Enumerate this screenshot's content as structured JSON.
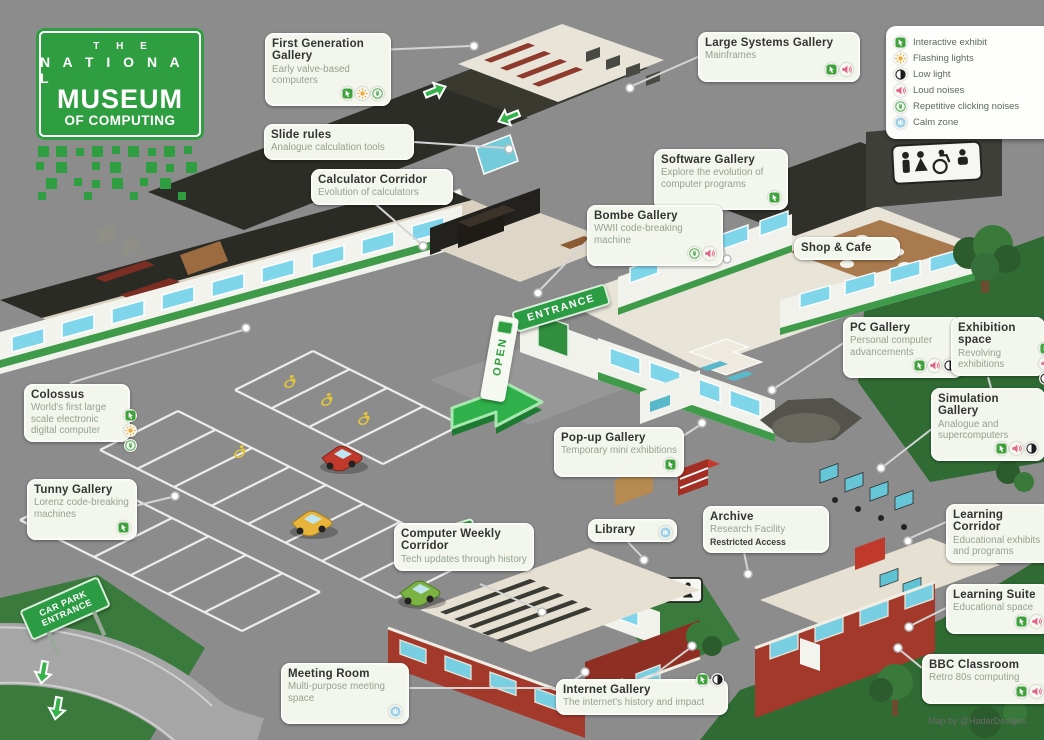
{
  "logo": {
    "line1": "T H E",
    "line2": "N A T I O N A L",
    "line3": "MUSEUM",
    "line4": "OF COMPUTING"
  },
  "legend": {
    "items": [
      {
        "icon": "interactive",
        "label": "Interactive exhibit"
      },
      {
        "icon": "flashing",
        "label": "Flashing lights"
      },
      {
        "icon": "low-light",
        "label": "Low light"
      },
      {
        "icon": "loud",
        "label": "Loud noises"
      },
      {
        "icon": "clicking",
        "label": "Repetitive clicking noises"
      },
      {
        "icon": "calm",
        "label": "Calm zone"
      }
    ]
  },
  "labels": [
    {
      "id": "first-generation-gallery",
      "title": "First Generation Gallery",
      "subtitle": "Early valve-based computers",
      "icons": [
        "interactive",
        "flashing",
        "clicking"
      ]
    },
    {
      "id": "slide-rules",
      "title": "Slide rules",
      "subtitle": "Analogue calculation tools",
      "icons": []
    },
    {
      "id": "calculator-corridor",
      "title": "Calculator Corridor",
      "subtitle": "Evolution of calculators",
      "icons": []
    },
    {
      "id": "large-systems-gallery",
      "title": "Large Systems Gallery",
      "subtitle": "Mainframes",
      "icons": [
        "interactive",
        "loud"
      ]
    },
    {
      "id": "software-gallery",
      "title": "Software Gallery",
      "subtitle": "Explore the evolution of computer programs",
      "icons": [
        "interactive"
      ]
    },
    {
      "id": "bombe-gallery",
      "title": "Bombe Gallery",
      "subtitle": "WWII code-breaking machine",
      "icons": [
        "clicking",
        "loud"
      ]
    },
    {
      "id": "shop-cafe",
      "title": "Shop & Cafe",
      "subtitle": "",
      "icons": []
    },
    {
      "id": "pc-gallery",
      "title": "PC Gallery",
      "subtitle": "Personal computer advancements",
      "icons": [
        "interactive",
        "loud",
        "low-light"
      ]
    },
    {
      "id": "exhibition-space",
      "title": "Exhibition space",
      "subtitle": "Revolving exhibitions",
      "icons": [
        "interactive",
        "loud",
        "low-light"
      ]
    },
    {
      "id": "simulation-gallery",
      "title": "Simulation Gallery",
      "subtitle": "Analogue and supercomputers",
      "icons": [
        "interactive",
        "loud",
        "low-light"
      ]
    },
    {
      "id": "pop-up-gallery",
      "title": "Pop-up Gallery",
      "subtitle": "Temporary mini exhibitions",
      "icons": [
        "interactive"
      ]
    },
    {
      "id": "colossus",
      "title": "Colossus",
      "subtitle": "World's first large scale electronic digital computer",
      "icons": [
        "interactive",
        "flashing",
        "clicking"
      ]
    },
    {
      "id": "tunny-gallery",
      "title": "Tunny Gallery",
      "subtitle": "Lorenz code-breaking machines",
      "icons": [
        "interactive"
      ]
    },
    {
      "id": "computer-weekly-corridor",
      "title": "Computer Weekly Corridor",
      "subtitle": "Tech updates through history",
      "icons": []
    },
    {
      "id": "library",
      "title": "Library",
      "subtitle": "",
      "icons": [
        "calm"
      ]
    },
    {
      "id": "archive",
      "title": "Archive",
      "subtitle": "Research Facility",
      "note": "Restricted Access",
      "icons": []
    },
    {
      "id": "learning-corridor",
      "title": "Learning Corridor",
      "subtitle": "Educational exhibits and programs",
      "icons": []
    },
    {
      "id": "learning-suite",
      "title": "Learning Suite",
      "subtitle": "Educational space",
      "icons": [
        "interactive",
        "loud"
      ]
    },
    {
      "id": "bbc-classroom",
      "title": "BBC Classroom",
      "subtitle": "Retro 80s computing",
      "icons": [
        "interactive",
        "loud"
      ]
    },
    {
      "id": "meeting-room",
      "title": "Meeting Room",
      "subtitle": "Multi-purpose meeting space",
      "icons": [
        "calm"
      ]
    },
    {
      "id": "internet-gallery",
      "title": "Internet Gallery",
      "subtitle": "The internet's history and impact",
      "icons": [
        "interactive",
        "low-light"
      ]
    }
  ],
  "signs": {
    "entrance": "ENTRANCE",
    "exit": "EXIT",
    "car_park": "CAR PARK ENTRANCE",
    "open": "OPEN"
  },
  "credit": "Map by @HaderDesigns",
  "colors": {
    "brand_green": "#2f9e41",
    "label_bg": "#f2f6ec",
    "roof": "#2d2d27",
    "grass": "#2f6b33",
    "asphalt": "#8c8c8c",
    "brick": "#a2392b",
    "window": "#7fd6ea"
  }
}
